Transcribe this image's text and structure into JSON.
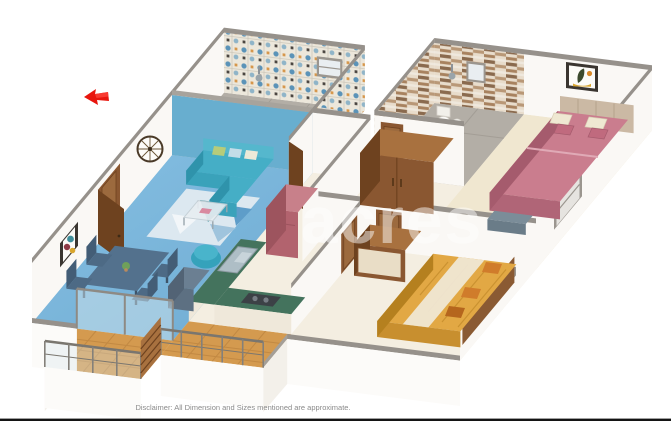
{
  "floorplan": {
    "kind": "3d-isometric-2bhk-floor-plan",
    "watermark": "acres",
    "disclaimer": "Disclaimer: All Dimension and Sizes mentioned are approximate.",
    "watermark_color": "#ffffff",
    "rooms": [
      {
        "name": "living-dining",
        "floor_color": "#7ab6da"
      },
      {
        "name": "kitchen",
        "floor_color": "#f4eee1"
      },
      {
        "name": "hallway",
        "floor_color": "#f4eee1"
      },
      {
        "name": "bathroom-1",
        "wall": "moroccan-pattern-tiles",
        "floor_color": "#b3aea6"
      },
      {
        "name": "bathroom-2",
        "wall": "brown-striped-tiles",
        "floor_color": "#b3aea6"
      },
      {
        "name": "bedroom-1",
        "floor_color": "#f0e7d0"
      },
      {
        "name": "bedroom-2",
        "floor_color": "#f4eee1"
      },
      {
        "name": "balcony",
        "floor_color": "#d49a4f"
      },
      {
        "name": "utility-balcony",
        "floor_color": "#d49a4f"
      }
    ],
    "colors": {
      "living_floor": "#7ab6da",
      "living_wall_blue": "#68aecf",
      "sofa_teal": "#45aec6",
      "sofa_dark": "#2f93ab",
      "pouf": "#35a2bb",
      "dining_wood": "#53718d",
      "bed1_pink": "#ca7d8e",
      "bed1_dark": "#b06577",
      "bed2_mustard": "#e2a844",
      "bed2_dark": "#c88f2f",
      "pillow_orange": "#d07c2b",
      "counter_green": "#44735d",
      "fridge_pink": "#b2636e",
      "terracotta": "#d49a4f",
      "wood": "#8a5731",
      "wood_light": "#a8713f",
      "wood_dark": "#6e421f",
      "wall_white": "#faf8f5",
      "wall_cap": "#96918b",
      "bath_floor": "#b3aea6",
      "arrow_red": "#e8150d"
    }
  }
}
